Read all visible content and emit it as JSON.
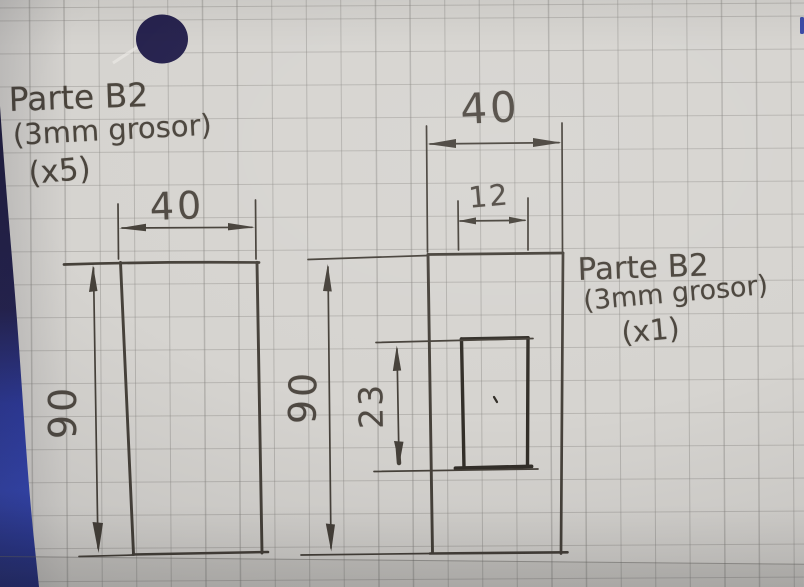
{
  "left_part": {
    "title": "Parte B2",
    "thickness_note": "(3mm grosor)",
    "quantity_note": "(x5)",
    "width": "40",
    "height": "90"
  },
  "right_part": {
    "title": "Parte B2",
    "thickness_note": "(3mm grosor)",
    "quantity_note": "(x1)",
    "width": "40",
    "height": "90",
    "slot_width": "12",
    "slot_height": "23"
  },
  "colors": {
    "paper": "#d6d4d0",
    "grid_line": "#8a8884",
    "pencil": "#46413a",
    "pencil_dark": "#332f29",
    "hole_dot": "#262250",
    "notebook_edge_blue": "#2e3ca4"
  }
}
